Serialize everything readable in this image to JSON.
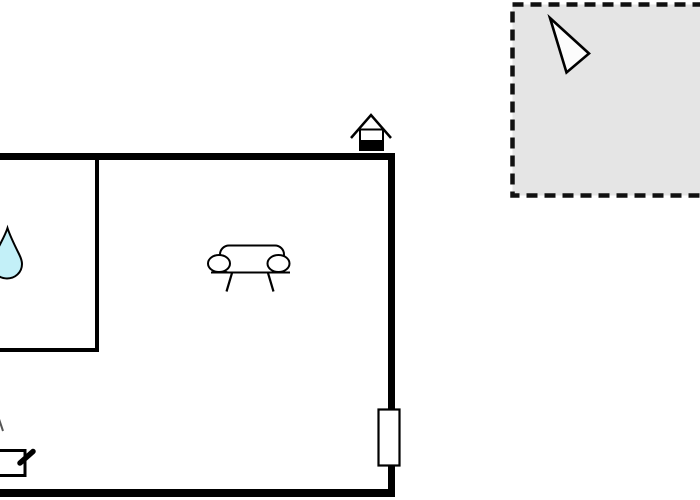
{
  "canvas": {
    "background": "#ffffff"
  },
  "colors": {
    "wall": "#000000",
    "line": "#000000",
    "white_fill": "#ffffff",
    "terrace_fill": "#e5e5e5",
    "terrace_border": "#111111",
    "water_drop_fill": "#c3f0f8",
    "pointer_fill": "#fcfcfc",
    "fragment_gray": "#555555"
  },
  "icons": {
    "entrance_marker": "house-icon",
    "living_area": "sofa-icon",
    "bathroom": "water-drop-icon",
    "kitchen": "stove-icon",
    "window": "window-marker",
    "terrace_pointer": "north-arrow-icon",
    "terrace": "terrace-dashed-area"
  }
}
